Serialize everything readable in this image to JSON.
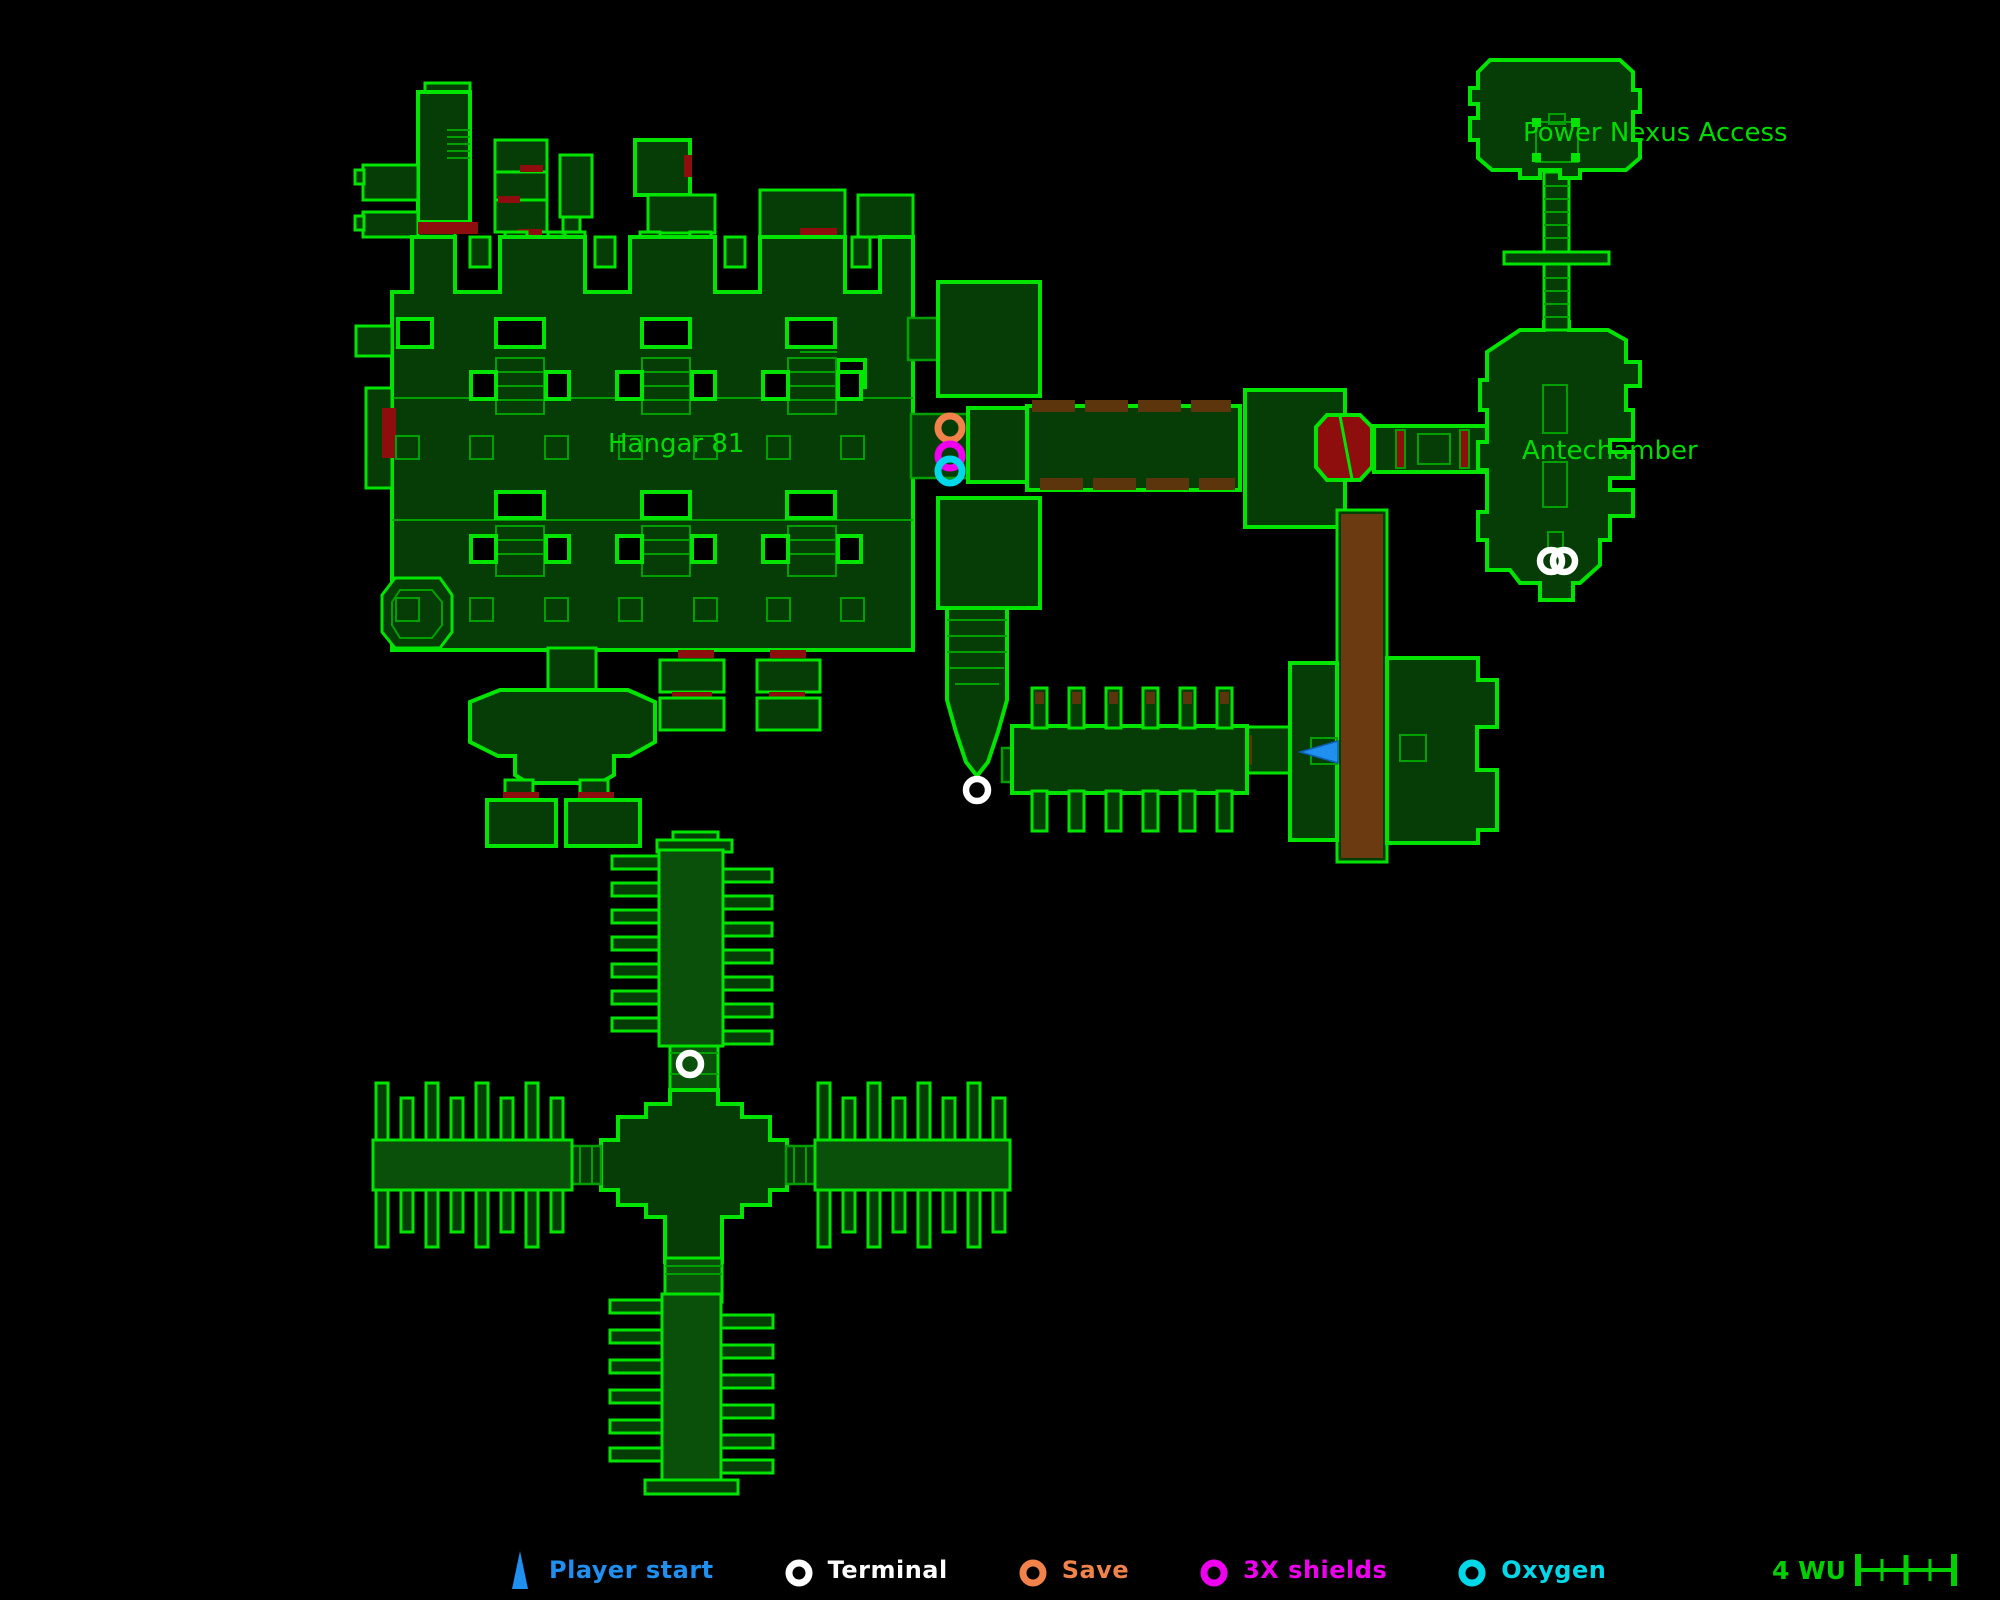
{
  "colors": {
    "map_outline_green": "#00e400",
    "map_interior_line_green": "#00a000",
    "room_fill_green": "#063c06",
    "label_green": "#00dc00",
    "scale_green": "#00d000",
    "door_red": "#8e0e0e",
    "platform_brown": "#6b3a10",
    "hazard_brown": "#5c350c",
    "player_start_blue": "#1f8ff0",
    "terminal_white": "#ffffff",
    "save_orange": "#f0824a",
    "shields_magenta": "#ee00ee",
    "oxygen_cyan": "#00d8ea",
    "background": "#000000"
  },
  "map": {
    "labels": [
      {
        "id": "hangar-81",
        "text": "Hangar 81",
        "x": 608,
        "y": 452
      },
      {
        "id": "power-nexus-access",
        "text": "Power Nexus Access",
        "x": 1523,
        "y": 141
      },
      {
        "id": "antechamber",
        "text": "Antechamber",
        "x": 1522,
        "y": 459
      }
    ],
    "markers": [
      {
        "type": "save",
        "x": 950,
        "y": 428
      },
      {
        "type": "shields",
        "x": 950,
        "y": 456
      },
      {
        "type": "oxygen",
        "x": 950,
        "y": 471
      },
      {
        "type": "terminal",
        "x": 977,
        "y": 790
      },
      {
        "type": "terminal",
        "x": 690,
        "y": 1064
      },
      {
        "type": "terminal",
        "x": 1551,
        "y": 561
      },
      {
        "type": "terminal",
        "x": 1564,
        "y": 561
      },
      {
        "type": "player_start",
        "x": 1300,
        "y": 752,
        "dir": "west"
      }
    ]
  },
  "legend": {
    "items": [
      {
        "id": "player-start",
        "label": "Player start",
        "marker": "triangle",
        "color": "#1f8ff0"
      },
      {
        "id": "terminal",
        "label": "Terminal",
        "marker": "ring",
        "color": "#ffffff"
      },
      {
        "id": "save",
        "label": "Save",
        "marker": "ring",
        "color": "#f0824a"
      },
      {
        "id": "shields",
        "label": "3X shields",
        "marker": "ring",
        "color": "#ee00ee"
      },
      {
        "id": "oxygen",
        "label": "Oxygen",
        "marker": "ring",
        "color": "#00d8ea"
      }
    ],
    "scale": {
      "label": "4 WU",
      "units": 4
    }
  }
}
